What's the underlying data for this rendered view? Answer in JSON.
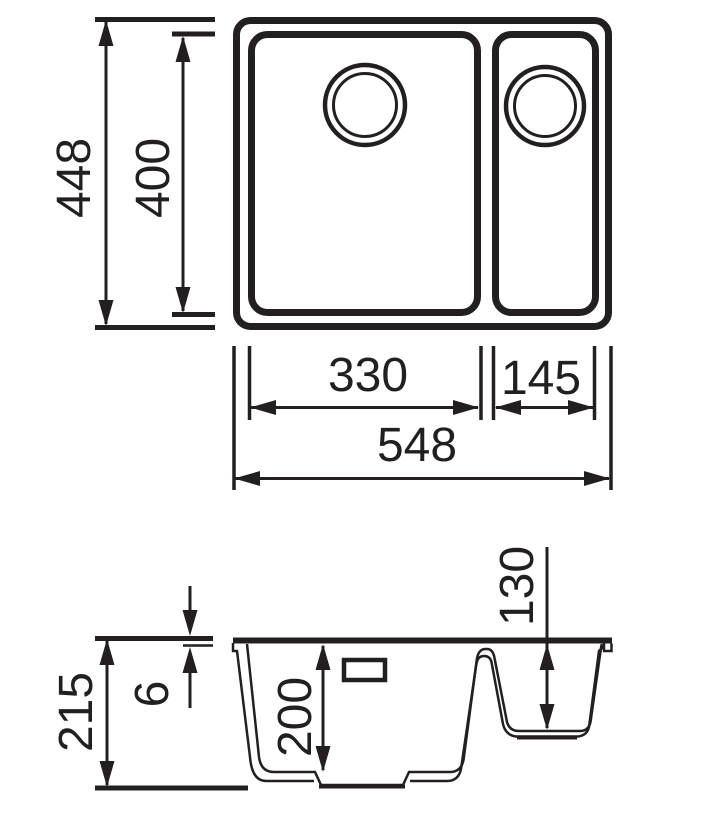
{
  "drawing": {
    "ink": "#231f20",
    "background": "#ffffff"
  },
  "top_view": {
    "outer_height": "448",
    "inner_height": "400",
    "main_bowl_width": "330",
    "half_bowl_width": "145",
    "overall_width": "548"
  },
  "section_view": {
    "overall_depth": "215",
    "rim_thickness": "6",
    "main_bowl_depth": "200",
    "half_bowl_depth": "130"
  }
}
